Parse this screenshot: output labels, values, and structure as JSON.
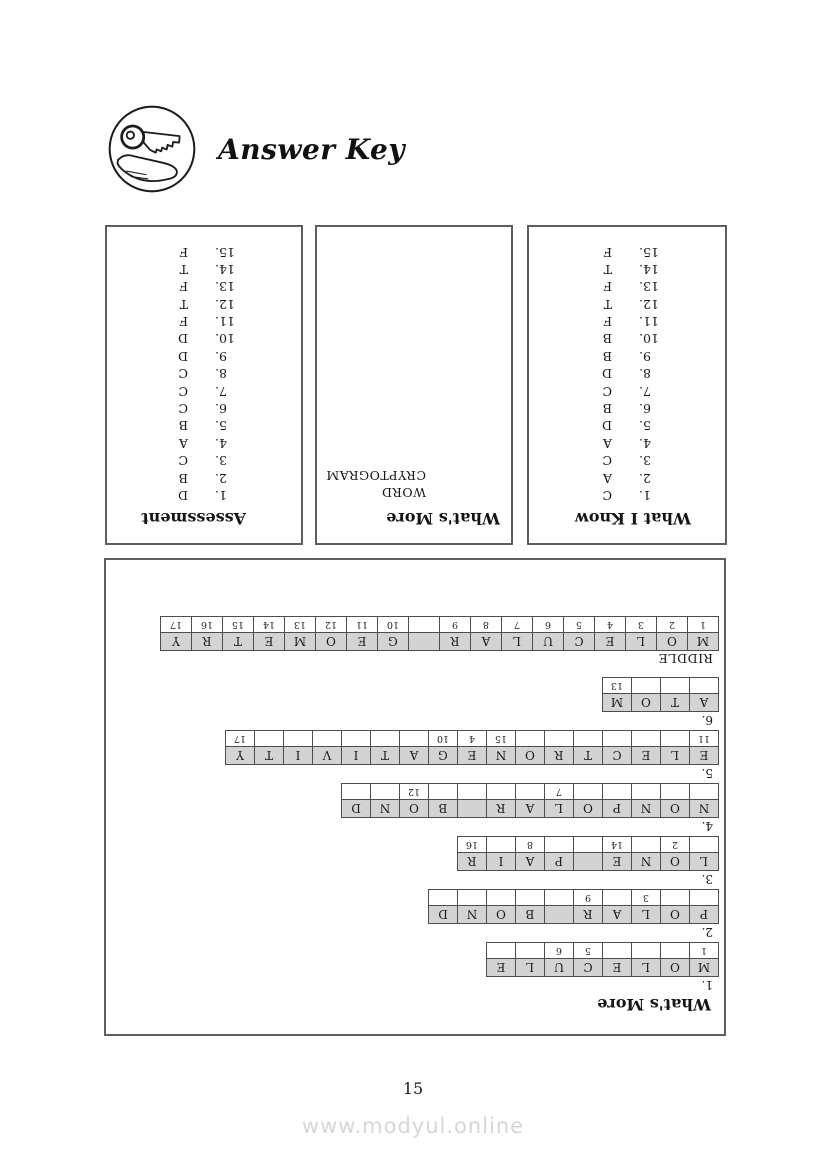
{
  "page": {
    "title": "Answer Key",
    "page_number": "15",
    "watermark": "www.modyul.online",
    "icon": "key-in-hand-icon"
  },
  "colors": {
    "cell_fill": "#d3d3d3",
    "box_border": "#5e5e5e",
    "watermark_gray": "#d6d6d6"
  },
  "boxes": {
    "what_i_know": {
      "title": "What I Know",
      "answers": [
        {
          "n": "1.",
          "a": "C"
        },
        {
          "n": "2.",
          "a": "A"
        },
        {
          "n": "3.",
          "a": "C"
        },
        {
          "n": "4.",
          "a": "A"
        },
        {
          "n": "5.",
          "a": "D"
        },
        {
          "n": "6.",
          "a": "B"
        },
        {
          "n": "7.",
          "a": "C"
        },
        {
          "n": "8.",
          "a": "D"
        },
        {
          "n": "9.",
          "a": "B"
        },
        {
          "n": "10.",
          "a": "B"
        },
        {
          "n": "11.",
          "a": "F"
        },
        {
          "n": "12.",
          "a": "T"
        },
        {
          "n": "13.",
          "a": "F"
        },
        {
          "n": "14.",
          "a": "T"
        },
        {
          "n": "15.",
          "a": "F"
        }
      ]
    },
    "whats_more_cryptogram": {
      "title": "What's More",
      "lines": [
        "WORD",
        "CRYPTOGRAM"
      ]
    },
    "assessment": {
      "title": "Assessment",
      "answers": [
        {
          "n": "1.",
          "a": "D"
        },
        {
          "n": "2.",
          "a": "B"
        },
        {
          "n": "3.",
          "a": "C"
        },
        {
          "n": "4.",
          "a": "A"
        },
        {
          "n": "5.",
          "a": "B"
        },
        {
          "n": "6.",
          "a": "C"
        },
        {
          "n": "7.",
          "a": "C"
        },
        {
          "n": "8.",
          "a": "C"
        },
        {
          "n": "9.",
          "a": "D"
        },
        {
          "n": "10.",
          "a": "D"
        },
        {
          "n": "11.",
          "a": "F"
        },
        {
          "n": "12.",
          "a": "T"
        },
        {
          "n": "13.",
          "a": "F"
        },
        {
          "n": "14.",
          "a": "T"
        },
        {
          "n": "15.",
          "a": "F"
        }
      ]
    }
  },
  "puzzle": {
    "title": "What's More",
    "items": [
      {
        "label": "1.",
        "answer": "MOLECULE",
        "letters": [
          "M",
          "O",
          "L",
          "E",
          "C",
          "U",
          "L",
          "E"
        ],
        "numbers": [
          "1",
          "",
          "",
          "",
          "5",
          "6",
          "",
          ""
        ]
      },
      {
        "label": "2.",
        "answer": "POLAR BOND",
        "letters": [
          "P",
          "O",
          "L",
          "A",
          "R",
          "",
          "B",
          "O",
          "N",
          "D"
        ],
        "numbers": [
          "",
          "",
          "3",
          "",
          "9",
          "",
          "",
          "",
          "",
          ""
        ]
      },
      {
        "label": "3.",
        "answer": "LONE PAIR",
        "letters": [
          "L",
          "O",
          "N",
          "E",
          "",
          "P",
          "A",
          "I",
          "R"
        ],
        "numbers": [
          "",
          "2",
          "",
          "14",
          "",
          "",
          "8",
          "",
          "16"
        ]
      },
      {
        "label": "4.",
        "answer": "NONPOLAR BOND",
        "letters": [
          "N",
          "O",
          "N",
          "P",
          "O",
          "L",
          "A",
          "R",
          "",
          "B",
          "O",
          "N",
          "D"
        ],
        "numbers": [
          "",
          "",
          "",
          "",
          "",
          "7",
          "",
          "",
          "",
          "",
          "12",
          "",
          ""
        ]
      },
      {
        "label": "5.",
        "answer": "ELECTRONEGATIVITY",
        "letters": [
          "E",
          "L",
          "E",
          "C",
          "T",
          "R",
          "O",
          "N",
          "E",
          "G",
          "A",
          "T",
          "I",
          "V",
          "I",
          "T",
          "Y"
        ],
        "numbers": [
          "11",
          "",
          "",
          "",
          "",
          "",
          "",
          "15",
          "4",
          "10",
          "",
          "",
          "",
          "",
          "",
          "",
          "17"
        ]
      },
      {
        "label": "6.",
        "answer": "ATOM",
        "letters": [
          "A",
          "T",
          "O",
          "M"
        ],
        "numbers": [
          "",
          "",
          "",
          "13"
        ]
      }
    ],
    "riddle": {
      "label": "RIDDLE",
      "answer": "MOLECULAR GEOMETRY",
      "letters": [
        "M",
        "O",
        "L",
        "E",
        "C",
        "U",
        "L",
        "A",
        "R",
        "",
        "G",
        "E",
        "O",
        "M",
        "E",
        "T",
        "R",
        "Y"
      ],
      "numbers": [
        "1",
        "2",
        "3",
        "4",
        "5",
        "6",
        "7",
        "8",
        "9",
        "",
        "10",
        "11",
        "12",
        "13",
        "14",
        "15",
        "16",
        "17"
      ]
    }
  }
}
